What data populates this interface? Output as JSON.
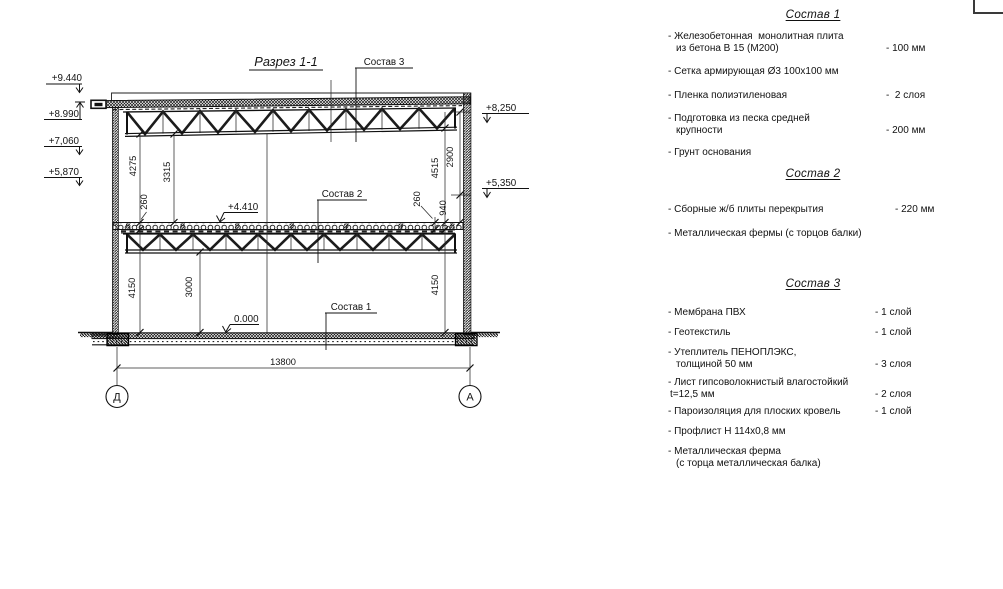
{
  "drawing": {
    "title": "Разрез 1-1",
    "axes": {
      "left": "Д",
      "right": "А"
    },
    "levels": {
      "l9440": "+9.440",
      "l8990": "+8.990",
      "l7060": "+7,060",
      "l5870": "+5,870",
      "r8250": "+8,250",
      "r5350": "+5,350",
      "floor": "+4.410",
      "zero": "0.000"
    },
    "dims": {
      "d4275": "4275",
      "d3315": "3315",
      "d260l": "260",
      "d4150l": "4150",
      "d3000": "3000",
      "d13800": "13800",
      "d4515": "4515",
      "d2900": "2900",
      "d260r": "260",
      "d940": "940",
      "d4150r": "4150"
    },
    "callouts": {
      "c1": "Состав 1",
      "c2": "Состав 2",
      "c3": "Состав 3"
    }
  },
  "legend": {
    "sections": [
      {
        "title": "Состав 1",
        "items": [
          {
            "line1": "- Железобетонная  монолитная плита",
            "line2": "из бетона В 15 (М200)",
            "value": "- 100 мм"
          },
          {
            "line1": "- Сетка армирующая Ø3 100х100 мм"
          },
          {
            "line1": "- Пленка полиэтиленовая",
            "value": "-  2 слоя"
          },
          {
            "line1": "- Подготовка из песка средней",
            "line2": "крупности",
            "value": "- 200 мм"
          },
          {
            "line1": "- Грунт основания"
          }
        ]
      },
      {
        "title": "Состав 2",
        "items": [
          {
            "line1": "- Сборные ж/б плиты перекрытия",
            "value": "- 220 мм"
          },
          {
            "line1": "- Металлическая фермы (с торцов балки)"
          }
        ]
      },
      {
        "title": "Состав 3",
        "items": [
          {
            "line1": "- Мембрана ПВХ",
            "value": "- 1 слой"
          },
          {
            "line1": "- Геотекстиль",
            "value": "- 1 слой"
          },
          {
            "line1": "- Утеплитель ПЕНОПЛЭКС,",
            "line2": "толщиной 50 мм",
            "value": "- 3 слоя"
          },
          {
            "line1": "- Лист гипсоволокнистый влагостойкий",
            "line2": "t=12,5 мм",
            "value": "- 2 слоя"
          },
          {
            "line1": "- Пароизоляция для плоских кровель",
            "value": "- 1 слой"
          },
          {
            "line1": "- Профлист Н 114х0,8 мм"
          },
          {
            "line1": "- Металлическая ферма",
            "line2": "(с торца металлическая балка)"
          }
        ]
      }
    ]
  }
}
